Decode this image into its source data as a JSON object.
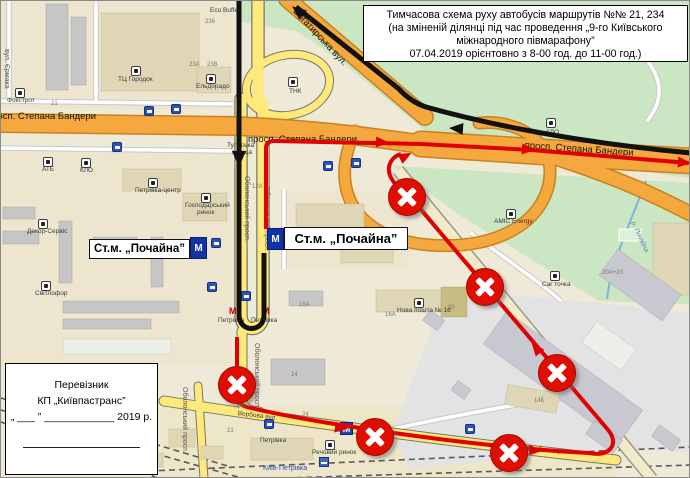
{
  "colors": {
    "map_bg": "#EFE9D8",
    "green_area": "#CBE6C2",
    "road_orange": "#F4A83E",
    "road_yellow": "#FFE97A",
    "red_route": "#E10000",
    "black_route": "#111111",
    "no_entry_red": "#E00E00",
    "metro_blue": "#2244BB",
    "water_blue": "#7FB8DC"
  },
  "title_box": {
    "lines": [
      "Тимчасова схема руху автобусів маршрутів №№ 21, 234",
      "(на зміненій ділянці під час проведення „9-го Київського",
      "міжнародного півмарафону”",
      "07.04.2019 орієнтовно з 8-00 год. до 11-00 год.)"
    ]
  },
  "carrier_box": {
    "line1": "Перевізник",
    "line2": "КП „Київпастранс”",
    "line3": "„ ___ ” ____________ 2019 р."
  },
  "stations": {
    "left": "Ст.м. „Почайна”",
    "right": "Ст.м. „Почайна”",
    "metro_letter": "М"
  },
  "map": {
    "street_labels": [
      {
        "name": "street-label-bandery-west",
        "text": "просп. Степана Бандери",
        "x": -14,
        "y": 111,
        "rot": 0,
        "cls": "lbl-road"
      },
      {
        "name": "street-label-bandery-mid",
        "text": "просп. Степана Бандери",
        "x": 247,
        "y": 134,
        "rot": 0,
        "cls": "lbl-road"
      },
      {
        "name": "street-label-bandery-east",
        "text": "просп. Степана Бандери",
        "x": 524,
        "y": 140,
        "rot": 4,
        "cls": "lbl-road"
      },
      {
        "name": "street-label-bogatyrska",
        "text": "Богатирська вул.",
        "x": 297,
        "y": 6,
        "rot": 47,
        "cls": "lbl-road"
      },
      {
        "name": "street-label-obolonskyi-1",
        "text": "Оболонський просп.",
        "x": 249,
        "y": 175,
        "rot": 90,
        "cls": "lbl-street-v"
      },
      {
        "name": "street-label-obolonskyi-2",
        "text": "Оболонський просп.",
        "x": 269,
        "y": 185,
        "rot": 90,
        "cls": "lbl-street-v"
      },
      {
        "name": "street-label-obolonskyi-3",
        "text": "Оболонський просп.",
        "x": 259,
        "y": 342,
        "rot": 90,
        "cls": "lbl-street-v"
      },
      {
        "name": "street-label-obolonskyi-4",
        "text": "Оболонський просп.",
        "x": 187,
        "y": 386,
        "rot": 90,
        "cls": "lbl-street-v"
      },
      {
        "name": "street-label-yermaka",
        "text": "вул. Єрмака",
        "x": 9,
        "y": 48,
        "rot": 90,
        "cls": "lbl-street-v"
      },
      {
        "name": "street-label-verbova-1",
        "text": "Вербова вул.",
        "x": 237,
        "y": 410,
        "rot": 7,
        "cls": "lbl"
      },
      {
        "name": "street-label-verbova-2",
        "text": "Вербова вул.",
        "x": 526,
        "y": 445,
        "rot": 5,
        "cls": "lbl"
      },
      {
        "name": "square-label-tulska-1",
        "text": "Тульська",
        "x": 226,
        "y": 142,
        "rot": 0,
        "cls": "lbl"
      },
      {
        "name": "square-label-tulska-2",
        "text": "площа",
        "x": 231,
        "y": 149,
        "rot": 0,
        "cls": "lbl"
      },
      {
        "name": "water-label-pochaina",
        "text": "р. Почайна",
        "x": 634,
        "y": 220,
        "rot": 65,
        "cls": "lbl-water"
      },
      {
        "name": "poi-label-hosp-rynok-2",
        "text": "ринок",
        "x": 196,
        "y": 209,
        "rot": 0,
        "cls": "lbl"
      }
    ],
    "pois": [
      {
        "name": "poi-foxtrot",
        "text": "Фокстрот",
        "x": 6,
        "y": 97,
        "ix": 14,
        "iy": 87
      },
      {
        "name": "poi-tc-horodok",
        "text": "ТЦ Городок",
        "x": 117,
        "y": 76,
        "ix": 130,
        "iy": 65
      },
      {
        "name": "poi-eldorado",
        "text": "Ельдорадо",
        "x": 195,
        "y": 83,
        "ix": 205,
        "iy": 73
      },
      {
        "name": "poi-eco-buffet",
        "text": "Eco Buffet",
        "x": 209,
        "y": 7
      },
      {
        "name": "poi-atb",
        "text": "АТБ",
        "x": 41,
        "y": 166,
        "ix": 42,
        "iy": 156
      },
      {
        "name": "poi-klo-west",
        "text": "КЛО",
        "x": 79,
        "y": 167,
        "ix": 80,
        "iy": 157
      },
      {
        "name": "poi-dekor-servis",
        "text": "Декор-Сервіс",
        "x": 26,
        "y": 228,
        "ix": 37,
        "iy": 218
      },
      {
        "name": "poi-svitlofor",
        "text": "Світлофор",
        "x": 34,
        "y": 290,
        "ix": 40,
        "iy": 280
      },
      {
        "name": "poi-petrivka-centr",
        "text": "Петрівка-центр",
        "x": 134,
        "y": 187,
        "ix": 147,
        "iy": 177
      },
      {
        "name": "poi-hosp-rynok",
        "text": "Господарський",
        "x": 184,
        "y": 202,
        "ix": 200,
        "iy": 192
      },
      {
        "name": "poi-makros",
        "text": "Макрос",
        "x": 354,
        "y": 240,
        "ix": 362,
        "iy": 231
      },
      {
        "name": "poi-nova-poshta",
        "text": "Нова пошта № 16",
        "x": 396,
        "y": 307,
        "ix": 413,
        "iy": 297
      },
      {
        "name": "poi-rechovyi-rynok",
        "text": "Речовий ринок",
        "x": 311,
        "y": 449,
        "ix": 324,
        "iy": 439
      },
      {
        "name": "poi-car-tochka",
        "text": "Car точка",
        "x": 541,
        "y": 281,
        "ix": 549,
        "iy": 270
      },
      {
        "name": "poi-amic-energy",
        "text": "AMIC Energy",
        "x": 493,
        "y": 218,
        "ix": 505,
        "iy": 208
      },
      {
        "name": "poi-klo-east",
        "text": "КЛО",
        "x": 545,
        "y": 129,
        "ix": 545,
        "iy": 117
      },
      {
        "name": "poi-tnk",
        "text": "ТНК",
        "x": 288,
        "y": 88,
        "ix": 287,
        "iy": 76
      }
    ],
    "numbers": [
      {
        "text": "21",
        "x": 50,
        "y": 100
      },
      {
        "text": "236",
        "x": 204,
        "y": 18
      },
      {
        "text": "23А",
        "x": 188,
        "y": 61
      },
      {
        "text": "23В",
        "x": 206,
        "y": 61
      },
      {
        "text": "12А",
        "x": 251,
        "y": 183
      },
      {
        "text": "14",
        "x": 290,
        "y": 371
      },
      {
        "text": "16А",
        "x": 298,
        "y": 301
      },
      {
        "text": "16А",
        "x": 384,
        "y": 311
      },
      {
        "text": "20",
        "x": 447,
        "y": 304
      },
      {
        "text": "24",
        "x": 301,
        "y": 411
      },
      {
        "text": "21",
        "x": 226,
        "y": 427
      },
      {
        "text": "14Б",
        "x": 533,
        "y": 397
      },
      {
        "text": "20А+20",
        "x": 601,
        "y": 269
      }
    ],
    "bus_stops": [
      [
        111,
        141
      ],
      [
        143,
        105
      ],
      [
        170,
        103
      ],
      [
        322,
        160
      ],
      [
        350,
        157
      ],
      [
        210,
        237
      ],
      [
        240,
        290
      ],
      [
        263,
        418
      ],
      [
        464,
        423
      ],
      [
        206,
        281
      ]
    ],
    "metro_entrances": [
      {
        "mx": 228,
        "my": 306,
        "lx": 217,
        "ly": 317,
        "text": "Петрівка"
      },
      {
        "mx": 261,
        "my": 306,
        "lx": 250,
        "ly": 317,
        "text": "Петрівка"
      }
    ],
    "metro_station": {
      "x": 339,
      "y": 421,
      "lx": 259,
      "ly": 437,
      "text": "Петрівка"
    },
    "rail_station": {
      "x": 318,
      "y": 456,
      "lx": 262,
      "ly": 464,
      "text": "Київ-Петрівка"
    },
    "no_entry_signs": [
      [
        406,
        196
      ],
      [
        484,
        286
      ],
      [
        556,
        372
      ],
      [
        236,
        384
      ],
      [
        374,
        436
      ],
      [
        508,
        452
      ]
    ]
  }
}
